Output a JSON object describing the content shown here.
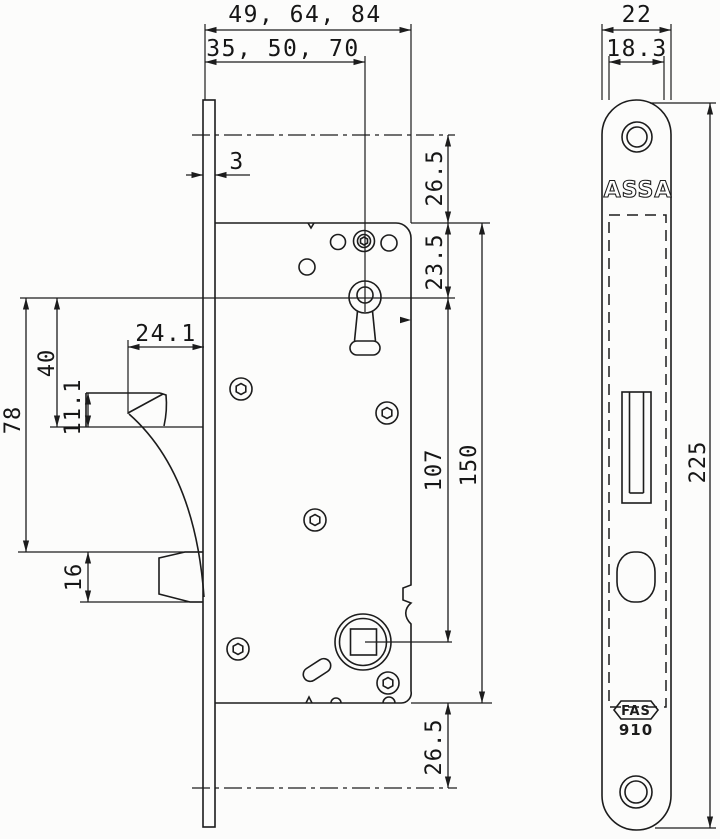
{
  "page": {
    "background": "#fcfcfb",
    "ink": "#1c1c1c"
  },
  "lock_body_view": {
    "dimensions": {
      "backset_outer": "49, 64, 84",
      "backset_inner": "35, 50, 70",
      "faceplate_thickness": "3",
      "top_to_case": "26.5",
      "case_to_key_center": "23.5",
      "hub_to_face": "24.1",
      "key_to_deadbolt_bottom": "40",
      "deadbolt_height": "11.1",
      "key_to_latch_top": "78",
      "latch_height": "16",
      "key_to_follower": "107",
      "case_height": "150",
      "case_to_bottom": "26.5"
    }
  },
  "faceplate_view": {
    "dimensions": {
      "plate_width": "22",
      "cutout_width": "18.3",
      "plate_height": "225"
    },
    "brand": "ASSA",
    "logo": "FAS",
    "model": "910"
  }
}
